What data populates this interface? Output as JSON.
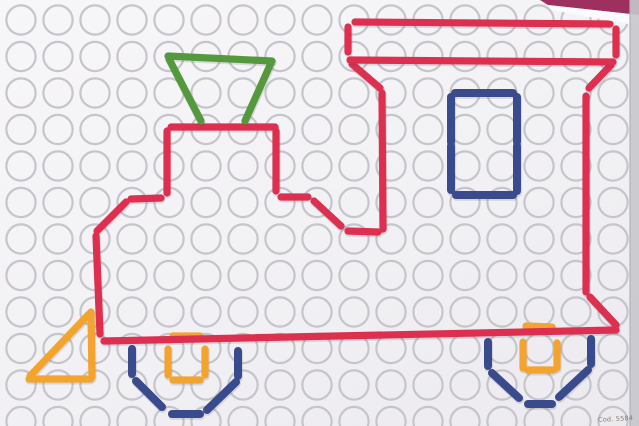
{
  "corner_label": "Cod. 5584",
  "palette": {
    "red": "#dd3050",
    "green": "#55993f",
    "blue": "#3a4b8d",
    "orange": "#f2a42f",
    "circle_stroke": "#c5c5cb",
    "board_edge_band": "#c7c7cc",
    "board_edge_line": "#b2b2b9",
    "backdrop_magenta": "#9e3060",
    "board_edge_highlight": "#fbfafc",
    "segment_shadow": "rgba(60,55,70,0.14)"
  },
  "grid": {
    "cols": 17,
    "rows": 12,
    "origin_x": 21,
    "origin_y": 20,
    "pitch_x": 37,
    "pitch_y": 36.5,
    "radius": 14.6,
    "stroke_width": 2.2
  },
  "photo_edges": {
    "backdrop_wedge": "540,0 639,0 639,15 548,5",
    "edge_highlight_wedge": "548,5 639,15 639,26 552,10",
    "right_band_x": 630,
    "right_band_w": 9
  },
  "figure": {
    "parts": [
      {
        "name": "front-wheel",
        "color": "blue",
        "stroke_width": 8,
        "segments": [
          [
            132,
            349,
            132,
            374
          ],
          [
            136,
            381,
            162,
            407
          ],
          [
            172,
            414,
            200,
            414
          ],
          [
            207,
            410,
            236,
            382
          ],
          [
            238,
            351,
            238,
            376
          ]
        ]
      },
      {
        "name": "rear-wheel",
        "color": "blue",
        "stroke_width": 8,
        "segments": [
          [
            488,
            342,
            488,
            366
          ],
          [
            492,
            373,
            519,
            398
          ],
          [
            528,
            404,
            552,
            404
          ],
          [
            559,
            397,
            588,
            370
          ],
          [
            591,
            339,
            591,
            364
          ]
        ]
      },
      {
        "name": "front-wheel-hub",
        "color": "orange",
        "stroke_width": 7.2,
        "segments": [
          [
            173,
            336,
            200,
            336
          ],
          [
            168,
            349,
            168,
            375
          ],
          [
            205,
            349,
            205,
            375
          ],
          [
            173,
            380,
            200,
            380
          ]
        ]
      },
      {
        "name": "rear-wheel-hub",
        "color": "orange",
        "stroke_width": 7.2,
        "segments": [
          [
            526,
            326,
            552,
            327
          ],
          [
            523,
            342,
            523,
            368
          ],
          [
            557,
            343,
            557,
            368
          ],
          [
            528,
            370,
            553,
            370
          ]
        ]
      },
      {
        "name": "locomotive-body-outline",
        "color": "red",
        "stroke_width": 7.2,
        "segments": [
          [
            352,
            64,
            380,
            88
          ],
          [
            382,
            93,
            383,
            229
          ],
          [
            611,
            65,
            589,
            88
          ],
          [
            586,
            96,
            586,
            292
          ],
          [
            590,
            297,
            616,
            325
          ],
          [
            616,
            330,
            104,
            341
          ],
          [
            100,
            334,
            96,
            236
          ],
          [
            97,
            231,
            126,
            202
          ],
          [
            131,
            199,
            161,
            198
          ],
          [
            167,
            193,
            167,
            131
          ],
          [
            171,
            127,
            275,
            127
          ],
          [
            276,
            131,
            276,
            191
          ],
          [
            281,
            197,
            308,
            197
          ],
          [
            314,
            201,
            341,
            226
          ],
          [
            348,
            231,
            378,
            232
          ]
        ]
      },
      {
        "name": "cab-roof",
        "color": "red",
        "stroke_width": 7.2,
        "segments": [
          [
            355,
            22,
            610,
            24
          ],
          [
            348,
            27,
            348,
            52
          ],
          [
            616,
            29,
            616,
            55
          ],
          [
            350,
            60,
            613,
            62
          ]
        ]
      },
      {
        "name": "chimney",
        "color": "green",
        "stroke_width": 7.2,
        "segments": [
          [
            168,
            56,
            272,
            61
          ],
          [
            169,
            59,
            201,
            121
          ],
          [
            271,
            63,
            245,
            121
          ]
        ]
      },
      {
        "name": "cab-window",
        "color": "blue",
        "stroke_width": 8,
        "segments": [
          [
            455,
            93,
            513,
            93
          ],
          [
            451,
            97,
            451,
            142
          ],
          [
            451,
            146,
            451,
            190
          ],
          [
            517,
            97,
            517,
            142
          ],
          [
            517,
            146,
            517,
            191
          ],
          [
            456,
            195,
            513,
            195
          ]
        ]
      },
      {
        "name": "cowcatcher",
        "color": "orange",
        "stroke_width": 7.2,
        "segments": [
          [
            91,
            312,
            92,
            377
          ],
          [
            29,
            379,
            90,
            379
          ],
          [
            89,
            314,
            30,
            376
          ]
        ]
      }
    ]
  }
}
